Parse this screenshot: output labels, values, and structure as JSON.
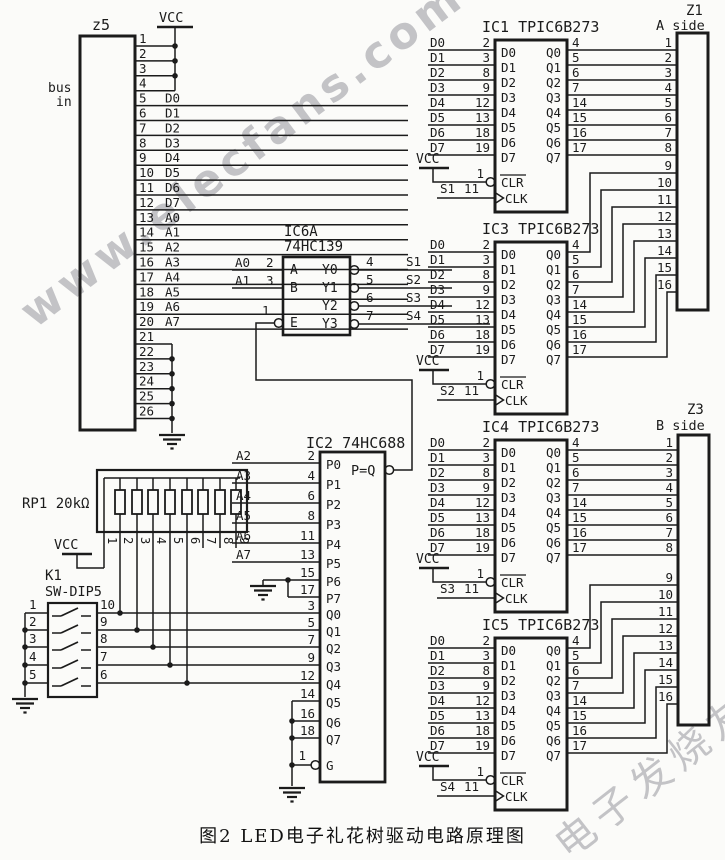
{
  "caption": "图2 LED电子礼花树驱动电路原理图",
  "watermark": {
    "diagonal": "www.elecfans.com",
    "corner": "电子发烧友"
  },
  "nets": {
    "vcc": "VCC"
  },
  "z5": {
    "ref": "z5",
    "side_note_line1": "bus",
    "side_note_line2": "in",
    "pins": [
      {
        "n": "1",
        "label": ""
      },
      {
        "n": "2",
        "label": ""
      },
      {
        "n": "3",
        "label": ""
      },
      {
        "n": "4",
        "label": ""
      },
      {
        "n": "5",
        "label": "D0"
      },
      {
        "n": "6",
        "label": "D1"
      },
      {
        "n": "7",
        "label": "D2"
      },
      {
        "n": "8",
        "label": "D3"
      },
      {
        "n": "9",
        "label": "D4"
      },
      {
        "n": "10",
        "label": "D5"
      },
      {
        "n": "11",
        "label": "D6"
      },
      {
        "n": "12",
        "label": "D7"
      },
      {
        "n": "13",
        "label": "A0"
      },
      {
        "n": "14",
        "label": "A1"
      },
      {
        "n": "15",
        "label": "A2"
      },
      {
        "n": "16",
        "label": "A3"
      },
      {
        "n": "17",
        "label": "A4"
      },
      {
        "n": "18",
        "label": "A5"
      },
      {
        "n": "19",
        "label": "A6"
      },
      {
        "n": "20",
        "label": "A7"
      },
      {
        "n": "21",
        "label": ""
      },
      {
        "n": "22",
        "label": ""
      },
      {
        "n": "23",
        "label": ""
      },
      {
        "n": "24",
        "label": ""
      },
      {
        "n": "25",
        "label": ""
      },
      {
        "n": "26",
        "label": ""
      }
    ]
  },
  "ic6a": {
    "ref": "IC6A",
    "part": "74HC139",
    "inputs": [
      {
        "net": "A0",
        "pin": "2",
        "port": "A"
      },
      {
        "net": "A1",
        "pin": "3",
        "port": "B"
      }
    ],
    "enable": {
      "pin": "1",
      "port": "E"
    },
    "outputs": [
      {
        "pin": "4",
        "port": "Y0",
        "net": "S1"
      },
      {
        "pin": "5",
        "port": "Y1",
        "net": "S2"
      },
      {
        "pin": "6",
        "port": "Y2",
        "net": "S3"
      },
      {
        "pin": "7",
        "port": "Y3",
        "net": "S4"
      }
    ]
  },
  "ic2": {
    "ref": "IC2",
    "part": "74HC688",
    "p_inputs": [
      {
        "net": "A2",
        "pin": "2",
        "port": "P0"
      },
      {
        "net": "A3",
        "pin": "4",
        "port": "P1"
      },
      {
        "net": "A4",
        "pin": "6",
        "port": "P2"
      },
      {
        "net": "A5",
        "pin": "8",
        "port": "P3"
      },
      {
        "net": "A6",
        "pin": "11",
        "port": "P4"
      },
      {
        "net": "A7",
        "pin": "13",
        "port": "P5"
      },
      {
        "net": "",
        "pin": "15",
        "port": "P6"
      },
      {
        "net": "",
        "pin": "17",
        "port": "P7"
      }
    ],
    "pq_label": "P=Q",
    "q_inputs": [
      {
        "pin": "3",
        "port": "Q0"
      },
      {
        "pin": "5",
        "port": "Q1"
      },
      {
        "pin": "7",
        "port": "Q2"
      },
      {
        "pin": "9",
        "port": "Q3"
      },
      {
        "pin": "12",
        "port": "Q4"
      },
      {
        "pin": "14",
        "port": "Q5"
      },
      {
        "pin": "16",
        "port": "Q6"
      },
      {
        "pin": "18",
        "port": "Q7"
      }
    ],
    "enable": {
      "pin": "1",
      "port": "G"
    }
  },
  "rp1": {
    "ref": "RP1 20kΩ",
    "pins": [
      "1",
      "2",
      "3",
      "4",
      "5",
      "6",
      "7",
      "8",
      "9"
    ]
  },
  "k1": {
    "ref": "K1",
    "part": "SW-DIP5",
    "left_pins": [
      "1",
      "2",
      "3",
      "4",
      "5"
    ],
    "right_pins": [
      "10",
      "9",
      "8",
      "7",
      "6"
    ]
  },
  "tpic_common": {
    "part": "TPIC6B273",
    "d_ports": [
      "D0",
      "D1",
      "D2",
      "D3",
      "D4",
      "D5",
      "D6",
      "D7"
    ],
    "d_pins": [
      "2",
      "3",
      "8",
      "9",
      "12",
      "13",
      "18",
      "19"
    ],
    "q_ports": [
      "Q0",
      "Q1",
      "Q2",
      "Q3",
      "Q4",
      "Q5",
      "Q6",
      "Q7"
    ],
    "q_pins": [
      "4",
      "5",
      "6",
      "7",
      "14",
      "15",
      "16",
      "17"
    ],
    "clr": {
      "pin": "1",
      "label": "CLR"
    },
    "clk": {
      "pin": "11",
      "label": "CLK"
    }
  },
  "tpic": [
    {
      "ref": "IC1",
      "clk_net": "S1"
    },
    {
      "ref": "IC3",
      "clk_net": "S2"
    },
    {
      "ref": "IC4",
      "clk_net": "S3"
    },
    {
      "ref": "IC5",
      "clk_net": "S4"
    }
  ],
  "z1": {
    "ref": "Z1",
    "side": "A side",
    "pins": [
      "1",
      "2",
      "3",
      "4",
      "5",
      "6",
      "7",
      "8",
      "9",
      "10",
      "11",
      "12",
      "13",
      "14",
      "15",
      "16"
    ]
  },
  "z3": {
    "ref": "Z3",
    "side": "B side",
    "pins": [
      "1",
      "2",
      "3",
      "4",
      "5",
      "6",
      "7",
      "8",
      "9",
      "10",
      "11",
      "12",
      "13",
      "14",
      "15",
      "16"
    ]
  }
}
